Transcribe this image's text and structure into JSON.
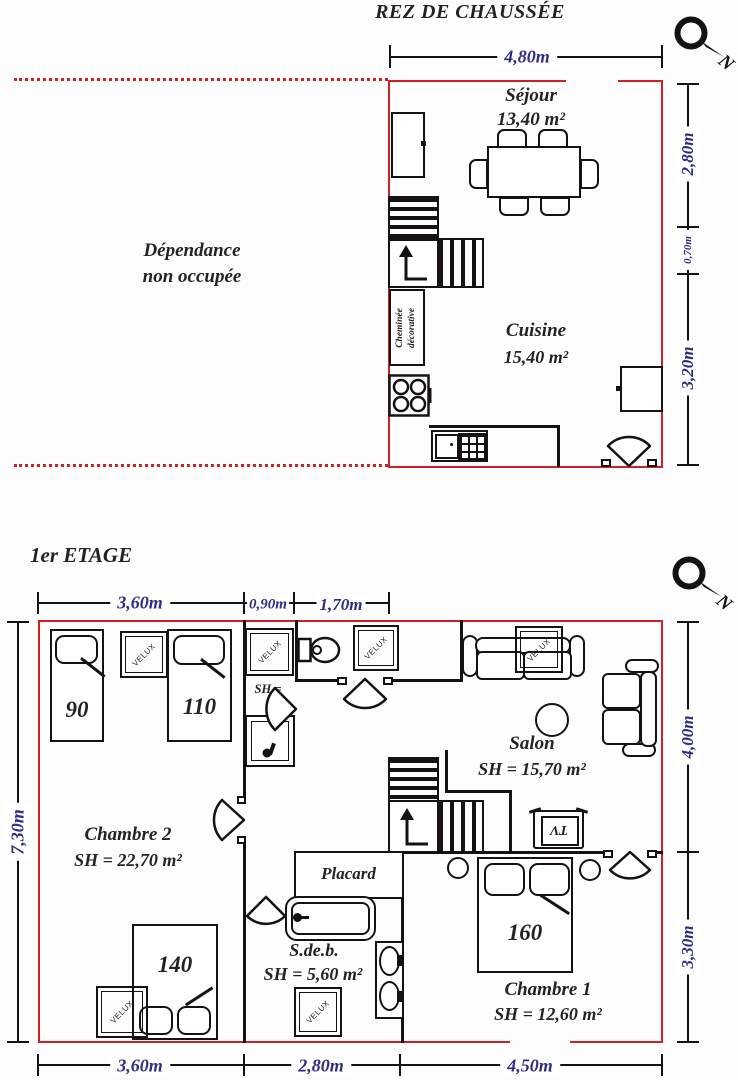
{
  "ground_floor": {
    "title": "REZ DE CHAUSSÉE",
    "compass_n": "N",
    "dim_top": "4,80m",
    "dim_right_top": "2,80m",
    "dim_right_mid": "0,70m",
    "dim_right_bottom": "3,20m",
    "sejour_name": "Séjour",
    "sejour_area": "13,40 m²",
    "cuisine_name": "Cuisine",
    "cuisine_area": "15,40 m²",
    "dependance_line1": "Dépendance",
    "dependance_line2": "non occupée",
    "cheminee_line1": "Cheminée",
    "cheminee_line2": "décorative"
  },
  "first_floor": {
    "title": "1er ETAGE",
    "compass_n": "N",
    "dim_top_left": "3,60m",
    "dim_top_mid": "0,90m",
    "dim_top_right": "1,70m",
    "dim_left": "7,30m",
    "dim_right_top": "4,00m",
    "dim_right_bottom": "3,30m",
    "dim_bottom_left": "3,60m",
    "dim_bottom_mid": "2,80m",
    "dim_bottom_right": "4,50m",
    "chambre2_name": "Chambre 2",
    "chambre2_area": "SH = 22,70 m²",
    "salon_name": "Salon",
    "salon_area": "SH = 15,70 m²",
    "placard_name": "Placard",
    "sdb_name": "S.de.b.",
    "sdb_area": "SH = 5,60 m²",
    "chambre1_name": "Chambre 1",
    "chambre1_area": "SH = 12,60 m²",
    "wc_line1": "SH =",
    "wc_line2": "2m",
    "bed90": "90",
    "bed110": "110",
    "bed140": "140",
    "bed160": "160",
    "tv_label": "TV",
    "velux_label": "VELUX"
  }
}
